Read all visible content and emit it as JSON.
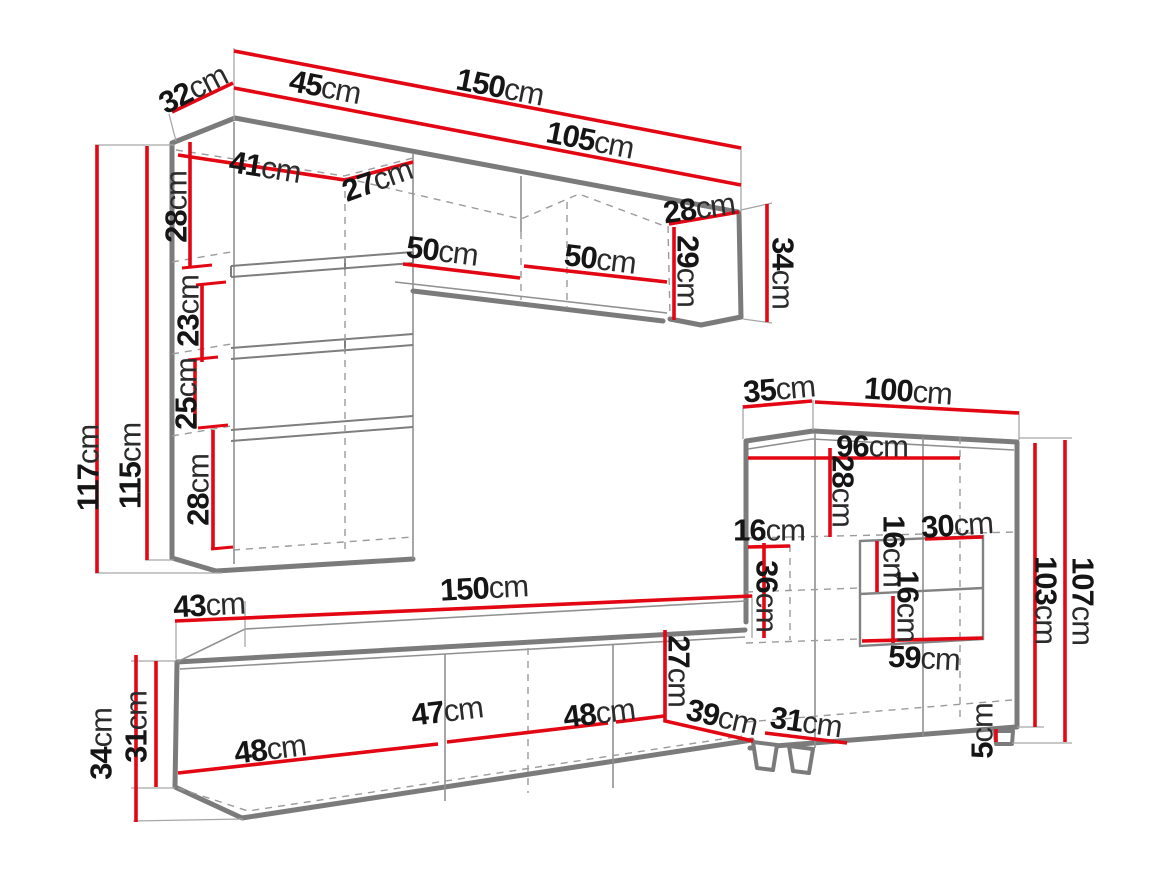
{
  "title": "Wall unit furniture dimensions diagram",
  "unit": "cm",
  "colors": {
    "dimension": "#e30613",
    "edge": "#7b7b7b",
    "thin": "#909090",
    "dash": "#9b9b9b",
    "text": "#151515",
    "background": "#ffffff"
  },
  "pieces": [
    {
      "name": "wall column cabinet",
      "measurements_cm": [
        32,
        45,
        41,
        27,
        28,
        23,
        25,
        28,
        117,
        115
      ]
    },
    {
      "name": "wall shelf",
      "measurements_cm": [
        150,
        105,
        50,
        50,
        28,
        29,
        34
      ]
    },
    {
      "name": "display cabinet",
      "measurements_cm": [
        35,
        100,
        96,
        28,
        16,
        36,
        16,
        30,
        16,
        59,
        103,
        107,
        31,
        5
      ]
    },
    {
      "name": "tv stand",
      "measurements_cm": [
        43,
        150,
        34,
        31,
        48,
        47,
        48,
        27,
        39
      ]
    }
  ],
  "labels": [
    {
      "id": "dim-32",
      "value": "32",
      "unit": "cm",
      "x": 193,
      "y": 89,
      "rot": -27
    },
    {
      "id": "dim-45",
      "value": "45",
      "unit": "cm",
      "x": 325,
      "y": 87,
      "rot": 11
    },
    {
      "id": "dim-150-top",
      "value": "150",
      "unit": "cm",
      "x": 500,
      "y": 87,
      "rot": 11
    },
    {
      "id": "dim-105",
      "value": "105",
      "unit": "cm",
      "x": 590,
      "y": 140,
      "rot": 11
    },
    {
      "id": "dim-41",
      "value": "41",
      "unit": "cm",
      "x": 265,
      "y": 167,
      "rot": 9
    },
    {
      "id": "dim-27-top",
      "value": "27",
      "unit": "cm",
      "x": 377,
      "y": 180,
      "rot": -20
    },
    {
      "id": "dim-28-column-top",
      "value": "28",
      "unit": "cm",
      "x": 176,
      "y": 207,
      "rot": -90
    },
    {
      "id": "dim-23",
      "value": "23",
      "unit": "cm",
      "x": 188,
      "y": 311,
      "rot": -90
    },
    {
      "id": "dim-25",
      "value": "25",
      "unit": "cm",
      "x": 186,
      "y": 394,
      "rot": -90
    },
    {
      "id": "dim-28-column-bottom",
      "value": "28",
      "unit": "cm",
      "x": 198,
      "y": 490,
      "rot": -90
    },
    {
      "id": "dim-117",
      "value": "117",
      "unit": "cm",
      "x": 88,
      "y": 468,
      "rot": -90
    },
    {
      "id": "dim-115",
      "value": "115",
      "unit": "cm",
      "x": 130,
      "y": 466,
      "rot": -90
    },
    {
      "id": "dim-50-left",
      "value": "50",
      "unit": "cm",
      "x": 442,
      "y": 251,
      "rot": 7
    },
    {
      "id": "dim-50-right",
      "value": "50",
      "unit": "cm",
      "x": 600,
      "y": 259,
      "rot": 7
    },
    {
      "id": "dim-28-shelf-end",
      "value": "28",
      "unit": "cm",
      "x": 699,
      "y": 208,
      "rot": -8
    },
    {
      "id": "dim-29",
      "value": "29",
      "unit": "cm",
      "x": 688,
      "y": 271,
      "rot": 90
    },
    {
      "id": "dim-34-shelf-end",
      "value": "34",
      "unit": "cm",
      "x": 783,
      "y": 273,
      "rot": 90
    },
    {
      "id": "dim-35",
      "value": "35",
      "unit": "cm",
      "x": 779,
      "y": 389,
      "rot": -5
    },
    {
      "id": "dim-100",
      "value": "100",
      "unit": "cm",
      "x": 908,
      "y": 391,
      "rot": 4
    },
    {
      "id": "dim-96",
      "value": "96",
      "unit": "cm",
      "x": 872,
      "y": 446,
      "rot": 0
    },
    {
      "id": "dim-28-cabinet",
      "value": "28",
      "unit": "cm",
      "x": 843,
      "y": 491,
      "rot": 90
    },
    {
      "id": "dim-16-cabinet-left",
      "value": "16",
      "unit": "cm",
      "x": 769,
      "y": 530,
      "rot": 0
    },
    {
      "id": "dim-36",
      "value": "36",
      "unit": "cm",
      "x": 767,
      "y": 596,
      "rot": 90
    },
    {
      "id": "dim-16-shelf-upper",
      "value": "16",
      "unit": "cm",
      "x": 894,
      "y": 551,
      "rot": 90
    },
    {
      "id": "dim-30",
      "value": "30",
      "unit": "cm",
      "x": 957,
      "y": 525,
      "rot": -4
    },
    {
      "id": "dim-16-shelf-lower",
      "value": "16",
      "unit": "cm",
      "x": 908,
      "y": 606,
      "rot": 90
    },
    {
      "id": "dim-59",
      "value": "59",
      "unit": "cm",
      "x": 924,
      "y": 658,
      "rot": 3
    },
    {
      "id": "dim-107",
      "value": "107",
      "unit": "cm",
      "x": 1083,
      "y": 601,
      "rot": 90
    },
    {
      "id": "dim-103",
      "value": "103",
      "unit": "cm",
      "x": 1046,
      "y": 600,
      "rot": 90
    },
    {
      "id": "dim-31-cabinet",
      "value": "31",
      "unit": "cm",
      "x": 806,
      "y": 722,
      "rot": 8
    },
    {
      "id": "dim-5",
      "value": "5",
      "unit": "cm",
      "x": 982,
      "y": 731,
      "rot": -90
    },
    {
      "id": "dim-43",
      "value": "43",
      "unit": "cm",
      "x": 209,
      "y": 605,
      "rot": -3
    },
    {
      "id": "dim-150-bottom",
      "value": "150",
      "unit": "cm",
      "x": 484,
      "y": 588,
      "rot": -3
    },
    {
      "id": "dim-34-tv",
      "value": "34",
      "unit": "cm",
      "x": 101,
      "y": 744,
      "rot": -90
    },
    {
      "id": "dim-31-tv",
      "value": "31",
      "unit": "cm",
      "x": 136,
      "y": 727,
      "rot": -90
    },
    {
      "id": "dim-48-door1",
      "value": "48",
      "unit": "cm",
      "x": 270,
      "y": 749,
      "rot": -7
    },
    {
      "id": "dim-47",
      "value": "47",
      "unit": "cm",
      "x": 447,
      "y": 711,
      "rot": -7
    },
    {
      "id": "dim-48-door2",
      "value": "48",
      "unit": "cm",
      "x": 599,
      "y": 713,
      "rot": -7
    },
    {
      "id": "dim-27-tv",
      "value": "27",
      "unit": "cm",
      "x": 679,
      "y": 671,
      "rot": 90
    },
    {
      "id": "dim-39",
      "value": "39",
      "unit": "cm",
      "x": 722,
      "y": 717,
      "rot": 13
    }
  ]
}
